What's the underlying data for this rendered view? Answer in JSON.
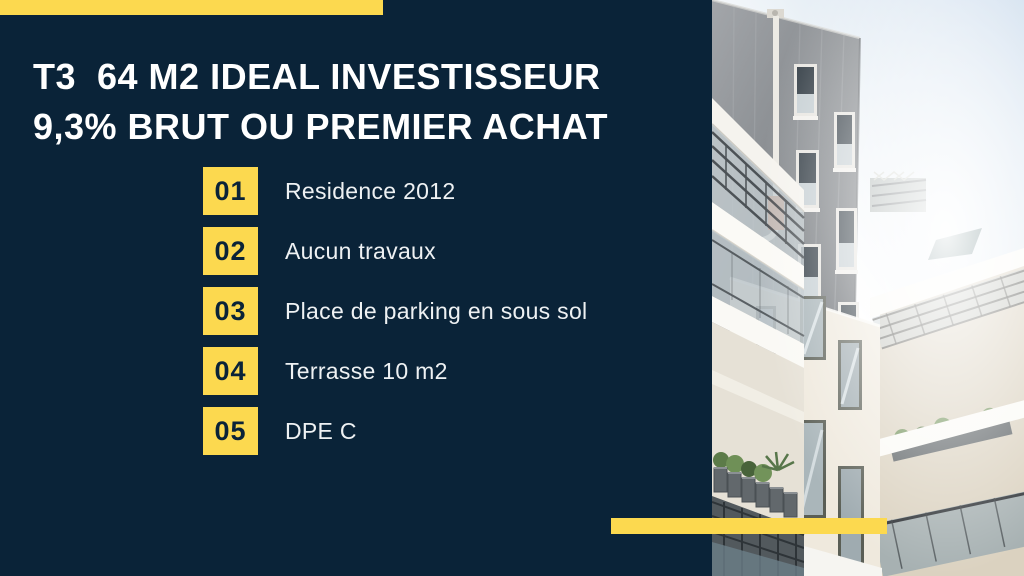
{
  "slide": {
    "background_color": "#0A2338",
    "accent_color": "#FCD94F",
    "title_color": "#FFFFFF",
    "title": {
      "line1": "T3  64 M2 IDEAL INVESTISSEUR",
      "line2": "9,3% BRUT OU PREMIER ACHAT"
    },
    "features": [
      {
        "number": "01",
        "label": "Residence 2012"
      },
      {
        "number": "02",
        "label": "Aucun travaux"
      },
      {
        "number": "03",
        "label": "Place de parking en sous sol"
      },
      {
        "number": "04",
        "label": "Terrasse 10 m2"
      },
      {
        "number": "05",
        "label": "DPE C"
      }
    ],
    "photo": {
      "alt": "Low-angle photo of a modern apartment building: gray panel tower with windows and drainpipe, white balconies with dark railings and planters, bright sunlit sky"
    }
  }
}
